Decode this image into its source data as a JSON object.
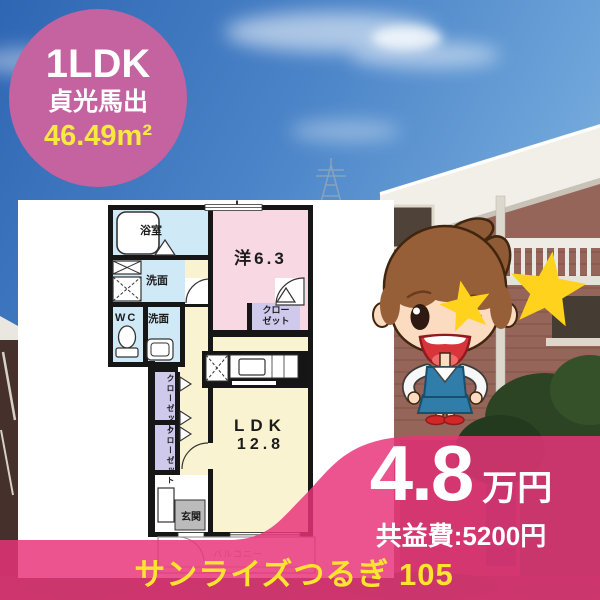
{
  "badge": {
    "type_label": "1LDK",
    "location": "貞光馬出",
    "area": "46.49m²"
  },
  "floorplan": {
    "bath": "浴室",
    "wash1": "洗面",
    "wc": "WC",
    "wash2": "洗面",
    "western_room": "洋6.3",
    "closet_line1": "クロー",
    "closet_line2": "ゼット",
    "closet_vertical": "クローゼット",
    "ldk_line1": "LDK",
    "ldk_line2": "12.8",
    "entrance": "玄関",
    "balcony": "バルコニー"
  },
  "price": {
    "rent": "4.8",
    "unit": "万円",
    "common_fee": "共益費:5200円"
  },
  "footer": {
    "property_name": "サンライズつるぎ 105"
  },
  "decor": {
    "star_count": 2,
    "star_color": "#ffd21e",
    "mascot": "office-lady-mascot"
  },
  "colors": {
    "badge_pink": "#c4639f",
    "overlay_pink": "#e7337a",
    "accent_yellow": "#f7e93f",
    "footer_yellow": "#ffe42e",
    "room_blue": "#cfe9f6",
    "room_pink": "#f8d9e3",
    "room_yellow": "#faf3d2",
    "room_purple": "#cfc9ec",
    "entrance_gray": "#bbbbbb"
  }
}
